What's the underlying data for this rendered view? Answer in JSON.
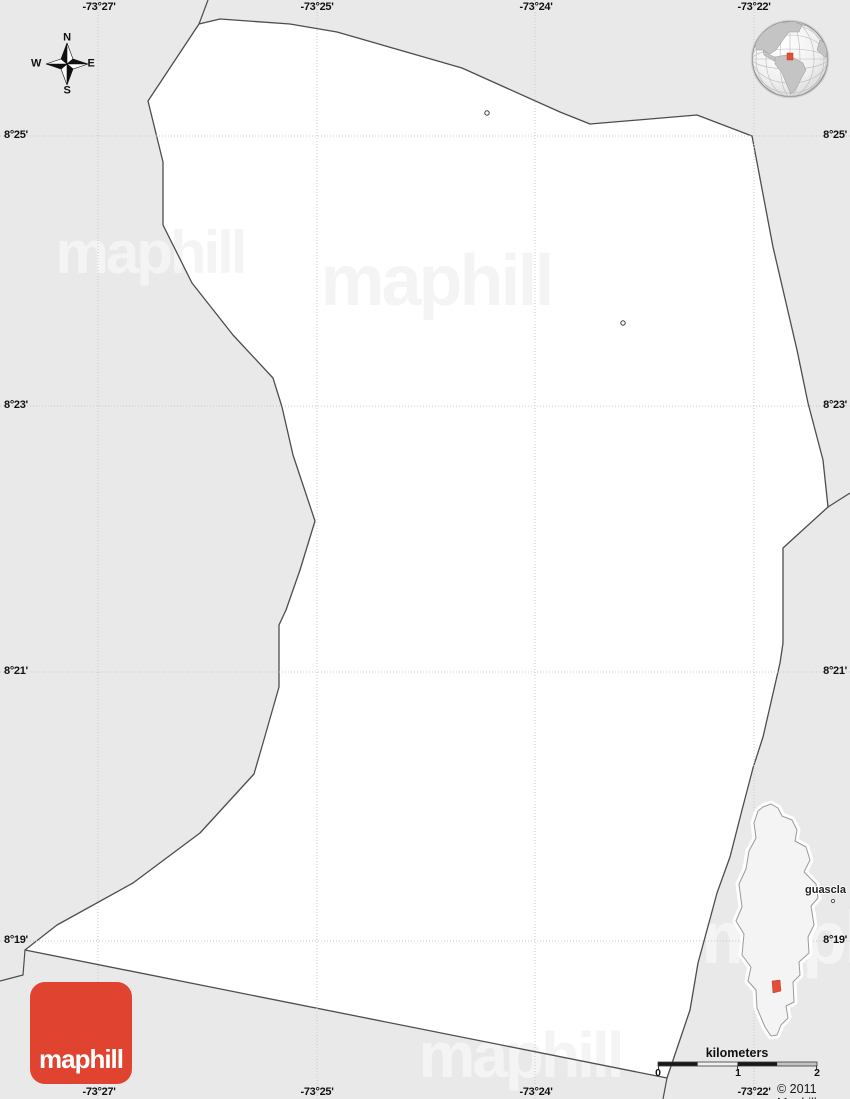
{
  "brand": {
    "watermark_text": "maphill",
    "logo_text": "maphill",
    "copyright": "© 2011 Maphill"
  },
  "grid": {
    "longitude_labels": [
      "-73°27'",
      "-73°25'",
      "-73°24'",
      "-73°22'"
    ],
    "latitude_labels": [
      "8°25'",
      "8°23'",
      "8°21'",
      "8°19'"
    ]
  },
  "compass": {
    "north": "N",
    "south": "S",
    "east": "E",
    "west": "W"
  },
  "scale_bar": {
    "title": "kilometers",
    "tick_labels": [
      "0",
      "1",
      "2"
    ]
  },
  "inset": {
    "place_label": "guascla"
  },
  "colors": {
    "background": "#e9e9e9",
    "region_fill": "#ffffff",
    "boundary": "#4d4d4d",
    "gridline": "#c9c9c9",
    "watermark": "#f4f4f4",
    "logo_red": "#e04430",
    "marker_red": "#e14f38"
  }
}
